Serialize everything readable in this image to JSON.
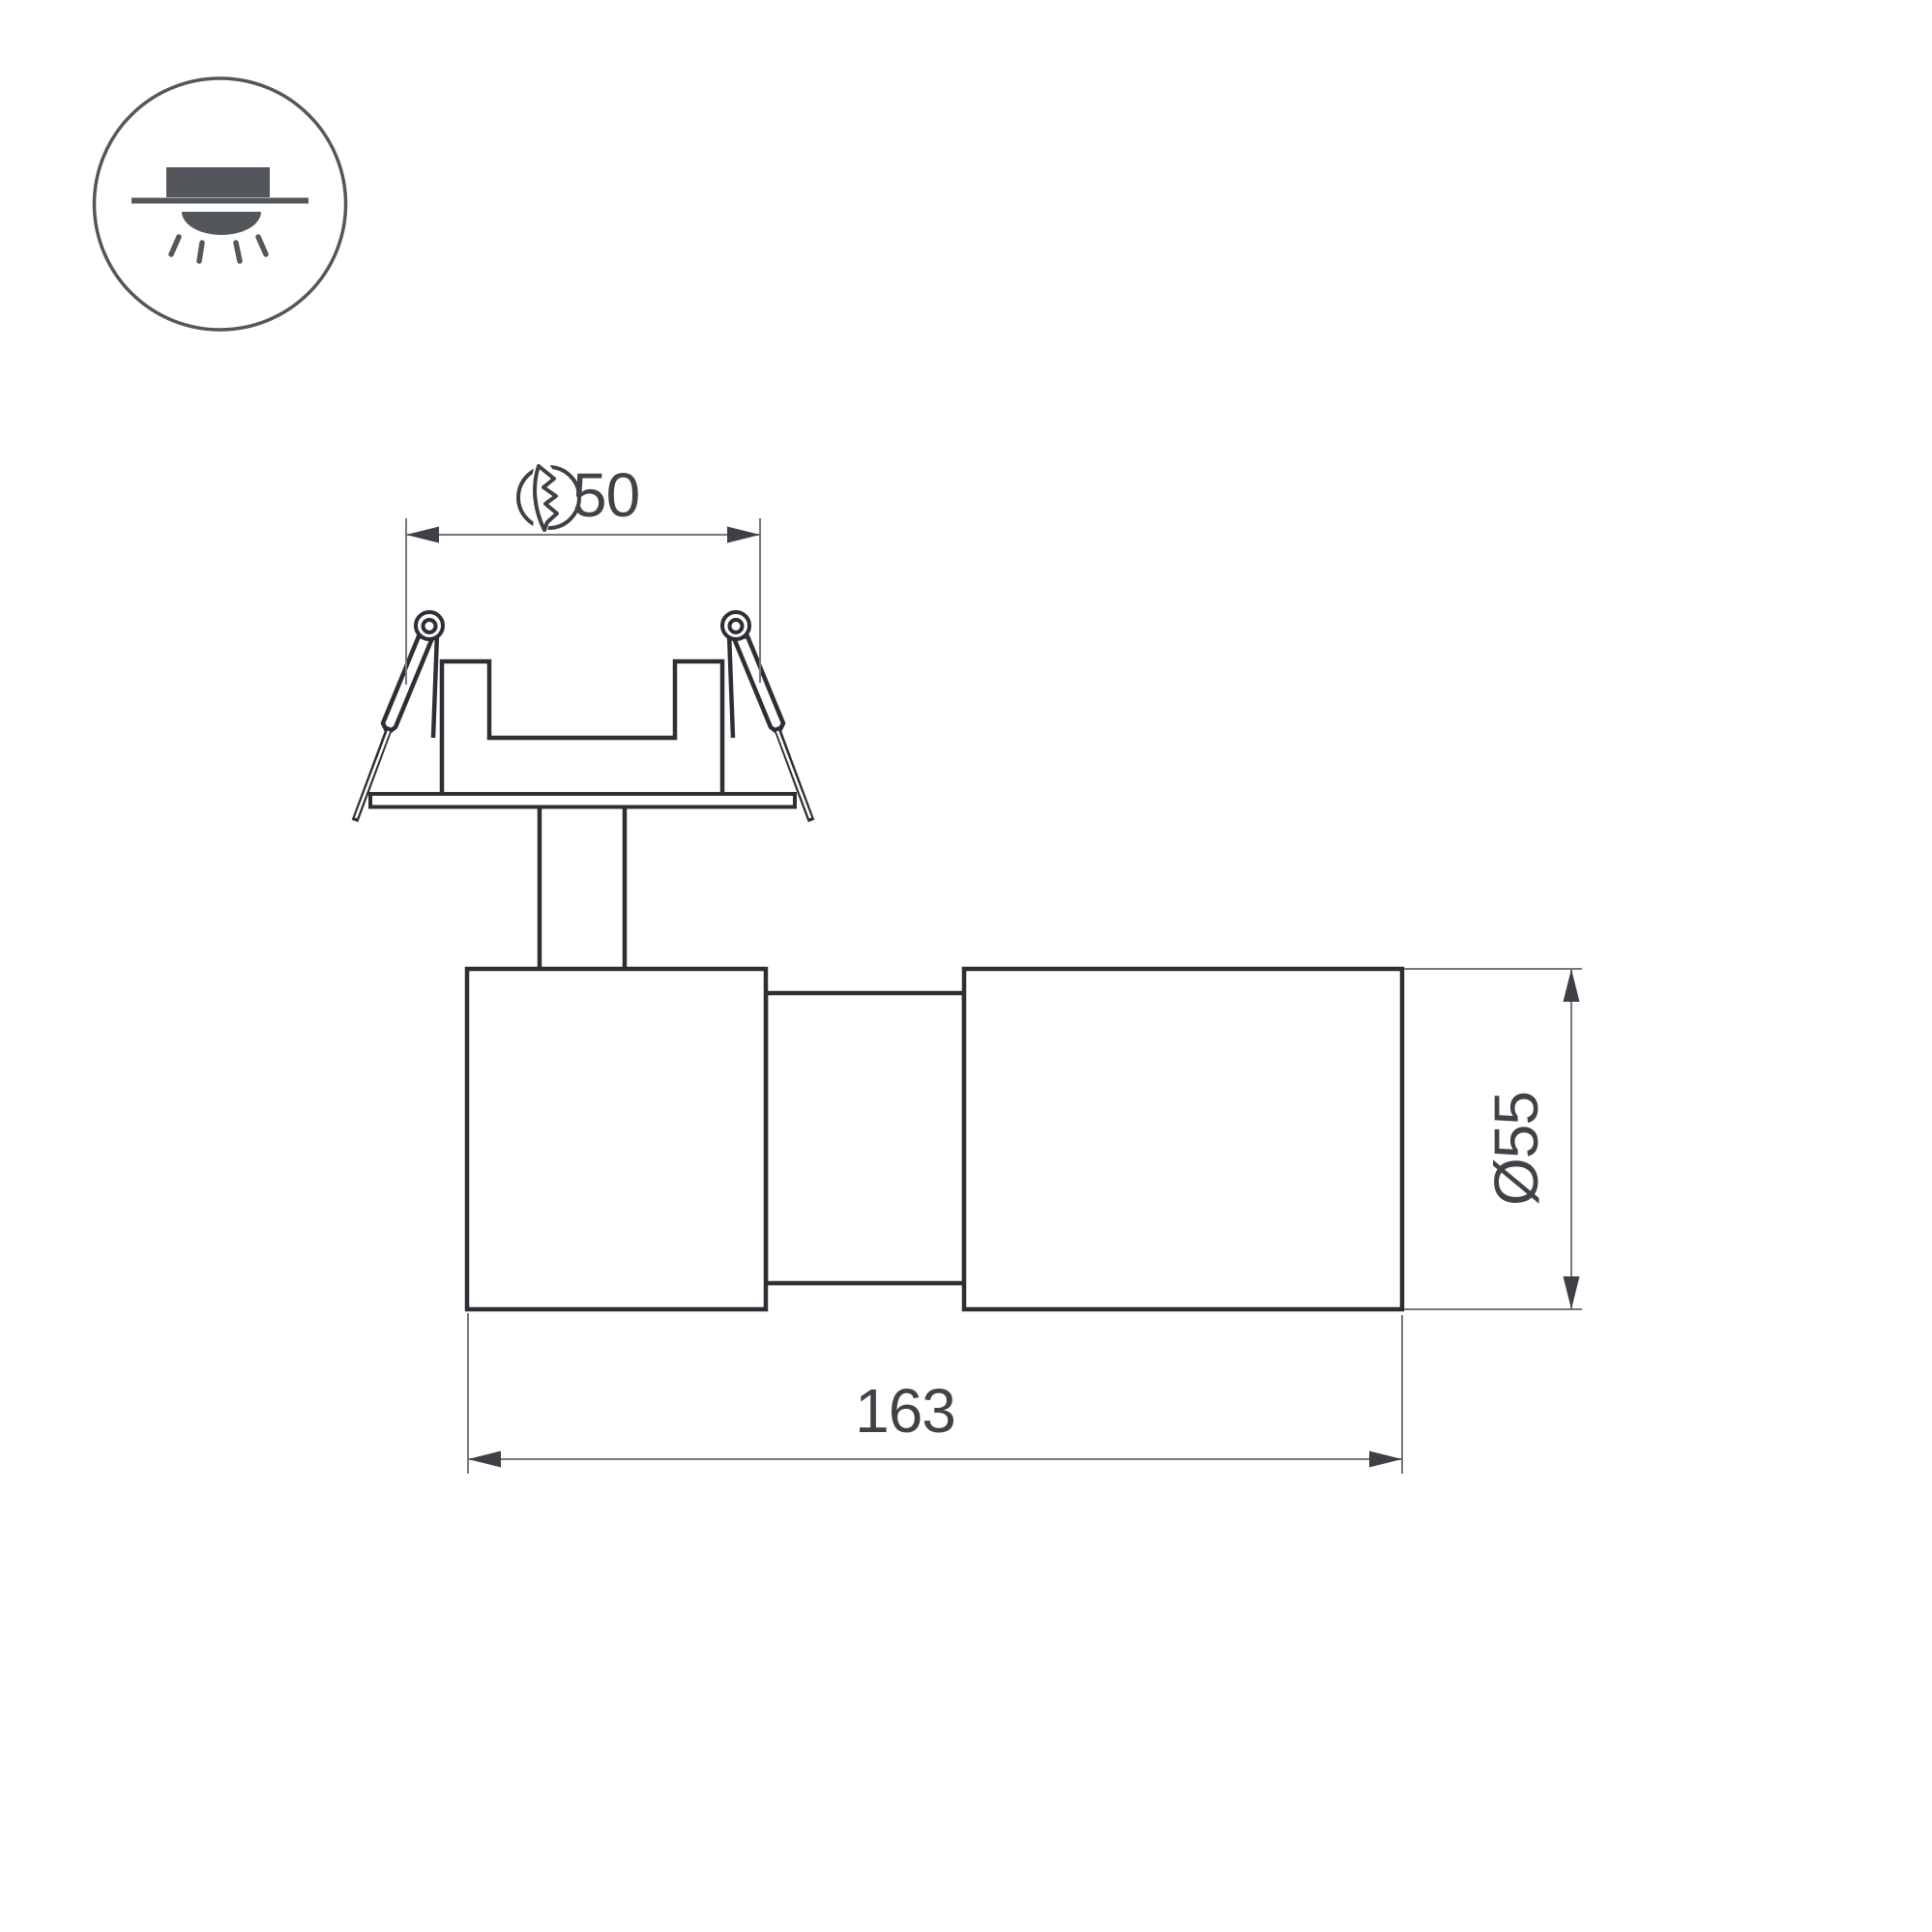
{
  "drawing": {
    "kind": "technical-dimension-drawing",
    "dimensions": {
      "mounting_hole": {
        "value": "50",
        "symbol": "cutout-hole"
      },
      "body_length": {
        "value": "163"
      },
      "body_diameter": {
        "value": "Ø55"
      }
    }
  },
  "colors": {
    "outline": "#2c2f33",
    "dimension_line": "#74777b",
    "arrow": "#3d4145",
    "text": "#3f4347",
    "icon": "#53575c",
    "background": "#ffffff"
  }
}
